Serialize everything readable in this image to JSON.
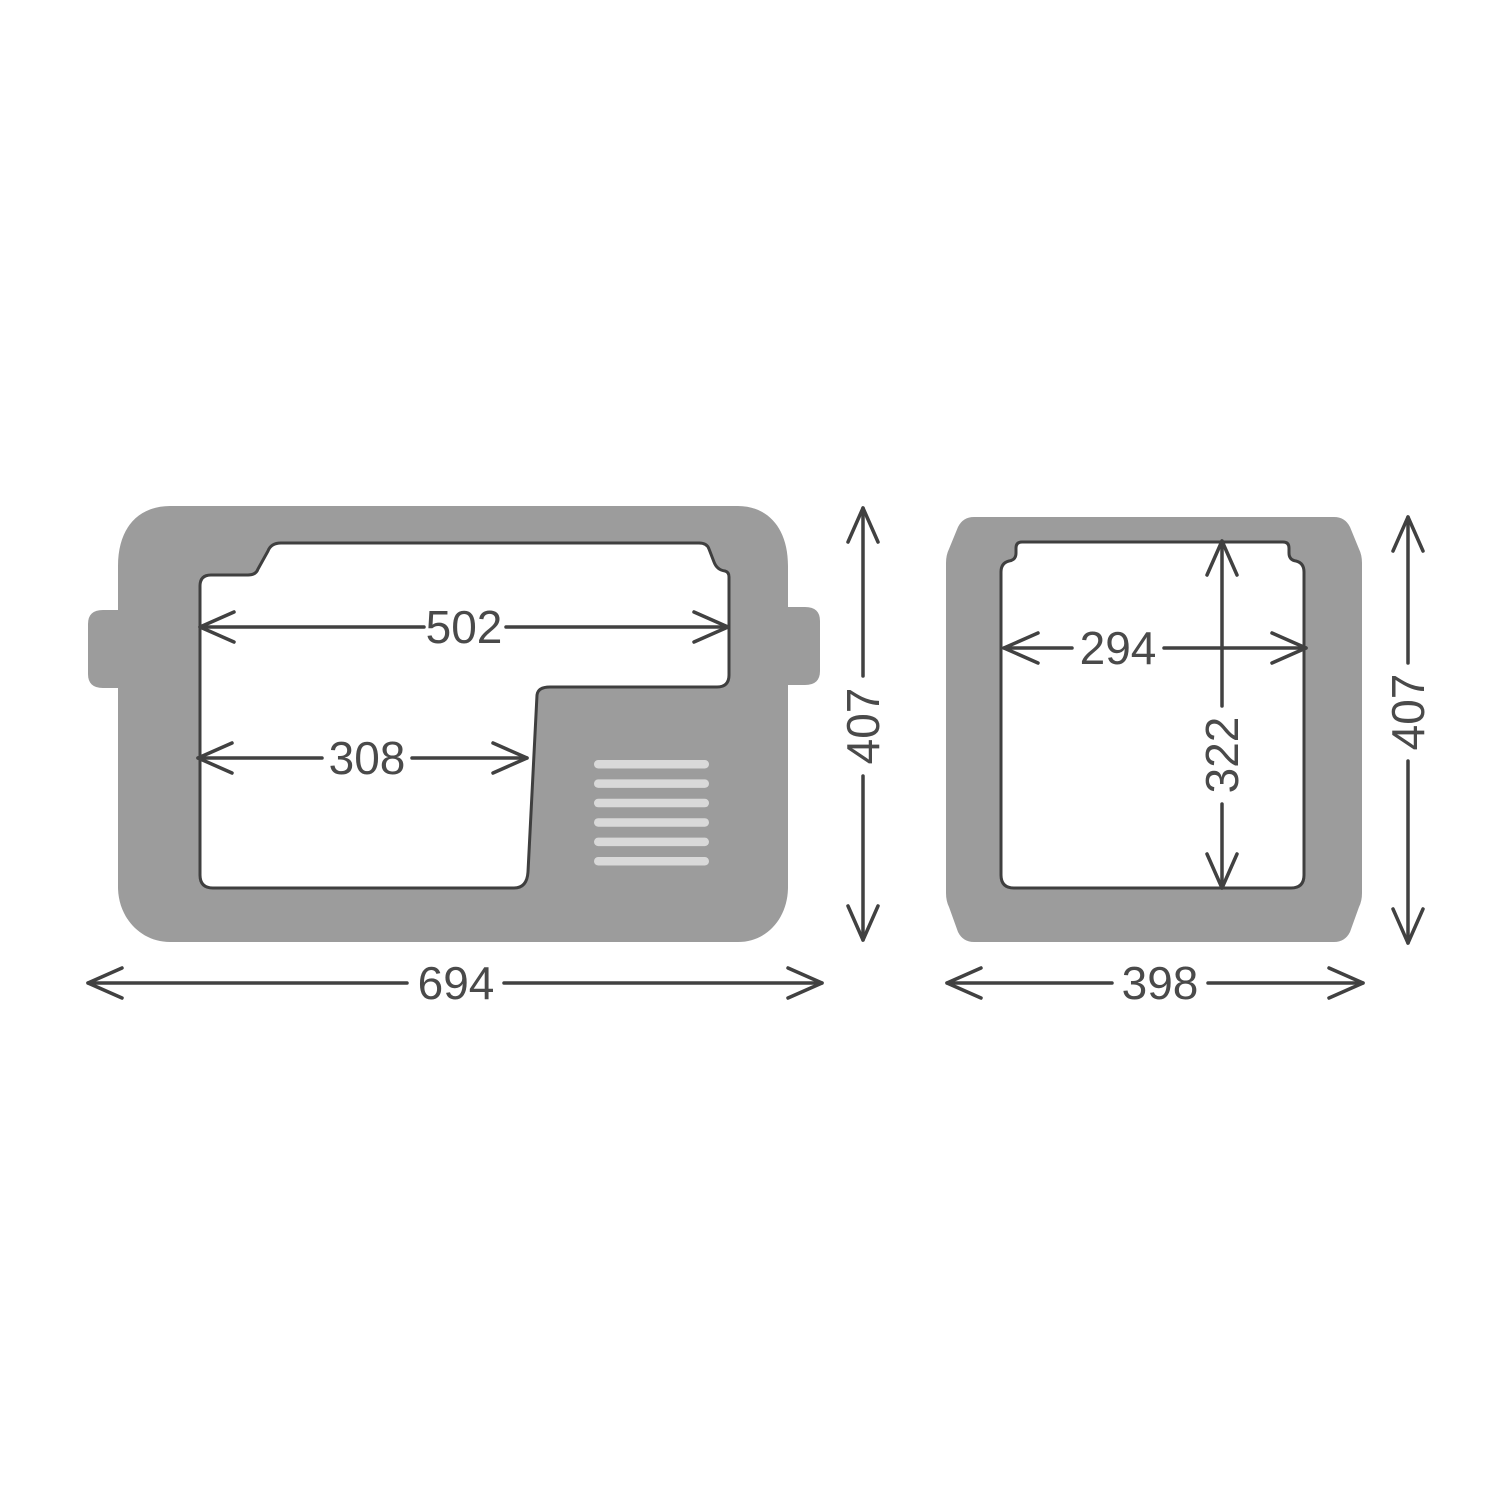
{
  "colors": {
    "background": "#ffffff",
    "body": "#9c9c9c",
    "cavity_fill": "#ffffff",
    "cavity_outline": "#3f3f3f",
    "dim_line": "#414141",
    "label_text": "#4a4a4a",
    "vent_slat": "#d9d9d9"
  },
  "front_view": {
    "name": "front-view",
    "dimensions": [
      {
        "name": "inner-width-top",
        "value": "502",
        "orientation": "horizontal"
      },
      {
        "name": "inner-width-lower",
        "value": "308",
        "orientation": "horizontal"
      },
      {
        "name": "overall-width",
        "value": "694",
        "orientation": "horizontal"
      },
      {
        "name": "overall-height",
        "value": "407",
        "orientation": "vertical"
      }
    ],
    "vent_slat_count": 6
  },
  "side_view": {
    "name": "side-view",
    "dimensions": [
      {
        "name": "inner-width",
        "value": "294",
        "orientation": "horizontal"
      },
      {
        "name": "inner-height",
        "value": "322",
        "orientation": "vertical"
      },
      {
        "name": "overall-width",
        "value": "398",
        "orientation": "horizontal"
      },
      {
        "name": "overall-height",
        "value": "407",
        "orientation": "vertical"
      }
    ]
  }
}
